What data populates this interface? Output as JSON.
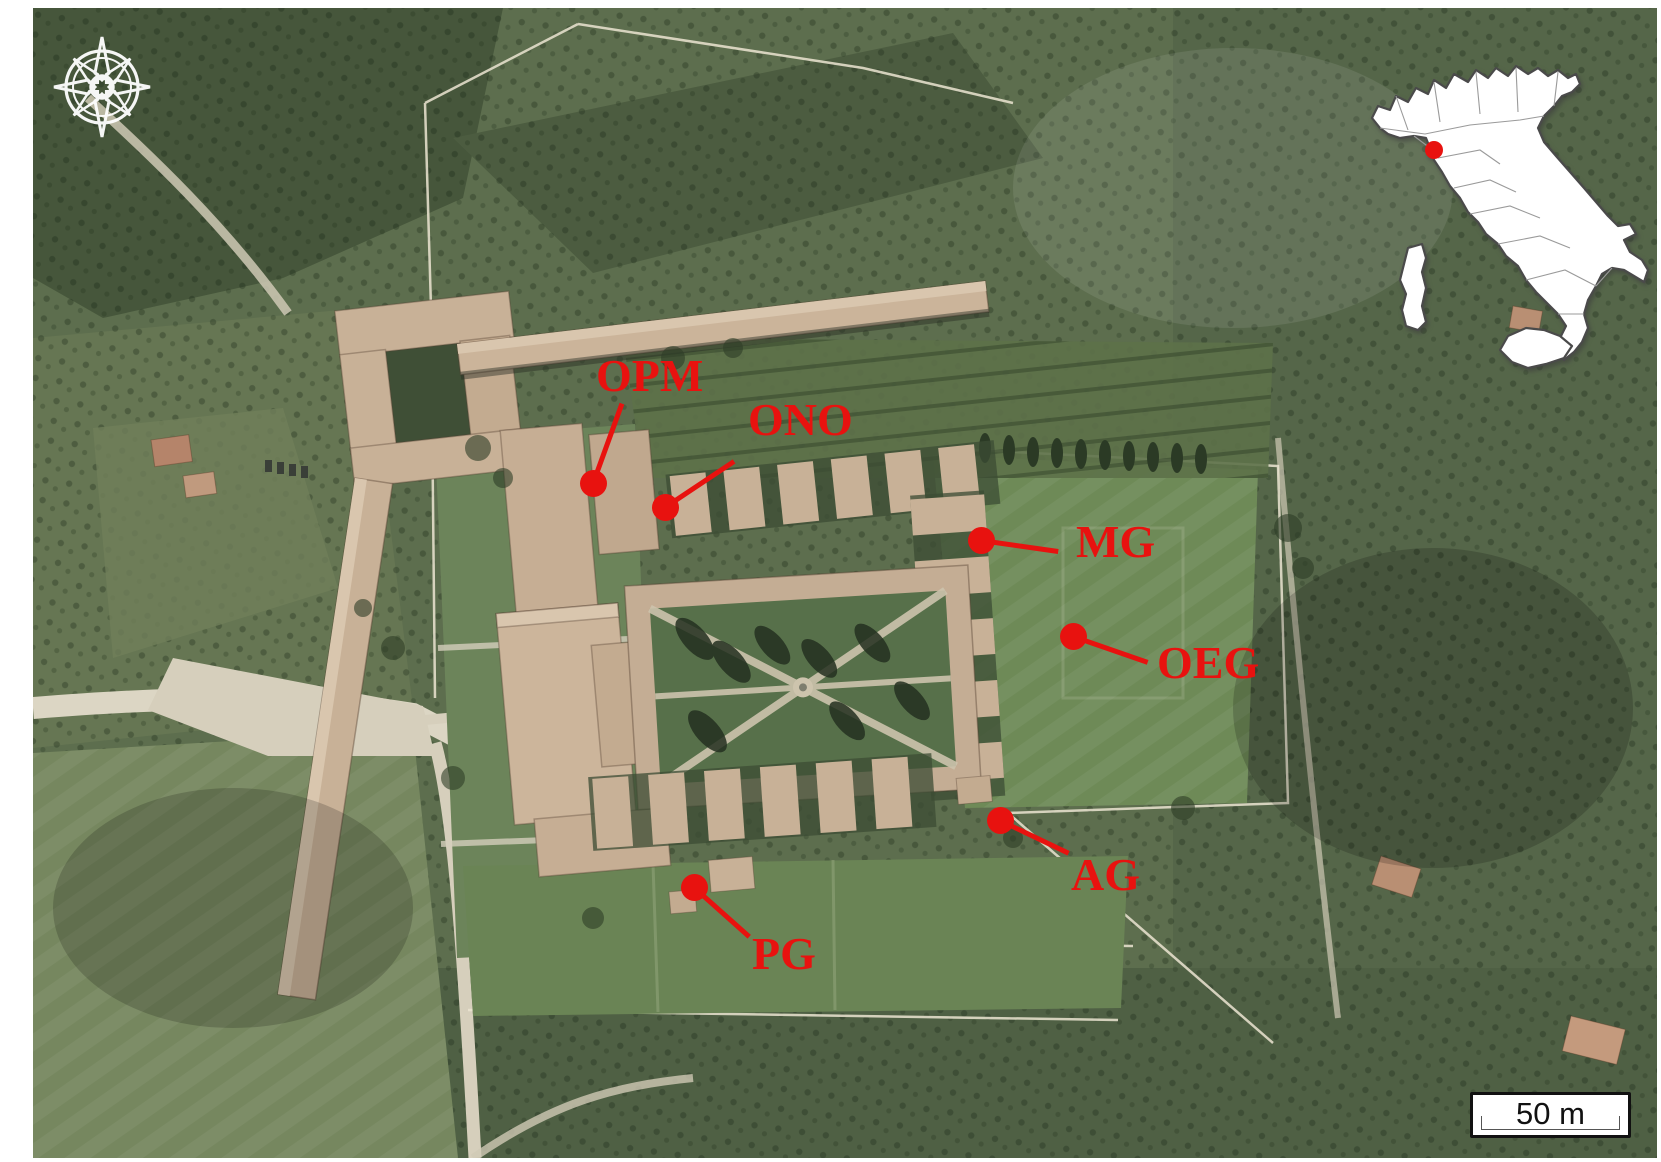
{
  "map": {
    "marker_color": "#e8120f",
    "markers": [
      {
        "id": "opm",
        "label": "OPM",
        "dot": {
          "x": 593,
          "y": 483
        },
        "line_end": {
          "x": 622,
          "y": 403
        },
        "text": {
          "x": 596,
          "y": 353
        }
      },
      {
        "id": "ono",
        "label": "ONO",
        "dot": {
          "x": 665,
          "y": 507
        },
        "line_end": {
          "x": 734,
          "y": 461
        },
        "text": {
          "x": 748,
          "y": 397
        }
      },
      {
        "id": "mg",
        "label": "MG",
        "dot": {
          "x": 981,
          "y": 540
        },
        "line_end": {
          "x": 1058,
          "y": 551
        },
        "text": {
          "x": 1076,
          "y": 519
        }
      },
      {
        "id": "oeg",
        "label": "OEG",
        "dot": {
          "x": 1073,
          "y": 636
        },
        "line_end": {
          "x": 1148,
          "y": 662
        },
        "text": {
          "x": 1157,
          "y": 640
        }
      },
      {
        "id": "ag",
        "label": "AG",
        "dot": {
          "x": 1000,
          "y": 820
        },
        "line_end": {
          "x": 1069,
          "y": 853
        },
        "text": {
          "x": 1071,
          "y": 852
        }
      },
      {
        "id": "pg",
        "label": "PG",
        "dot": {
          "x": 694,
          "y": 887
        },
        "line_end": {
          "x": 749,
          "y": 936
        },
        "text": {
          "x": 752,
          "y": 931
        }
      }
    ]
  },
  "inset_map": {
    "region_shown": "Italy",
    "marker_color": "#e8120f"
  },
  "scale_bar": {
    "label": "50 m"
  },
  "compass": {
    "icon": "compass-rose"
  }
}
